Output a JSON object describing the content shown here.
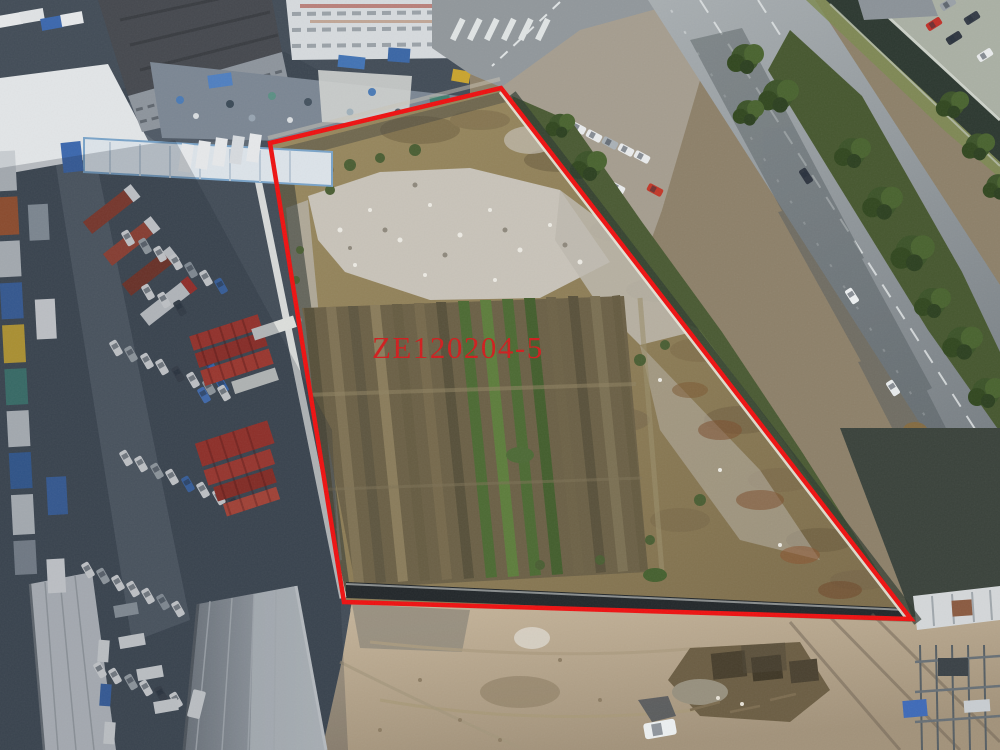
{
  "annotation": {
    "parcel_label": "ZE120204-5",
    "boundary_color": "#ee1111",
    "label_color": "#cf1e1e"
  }
}
